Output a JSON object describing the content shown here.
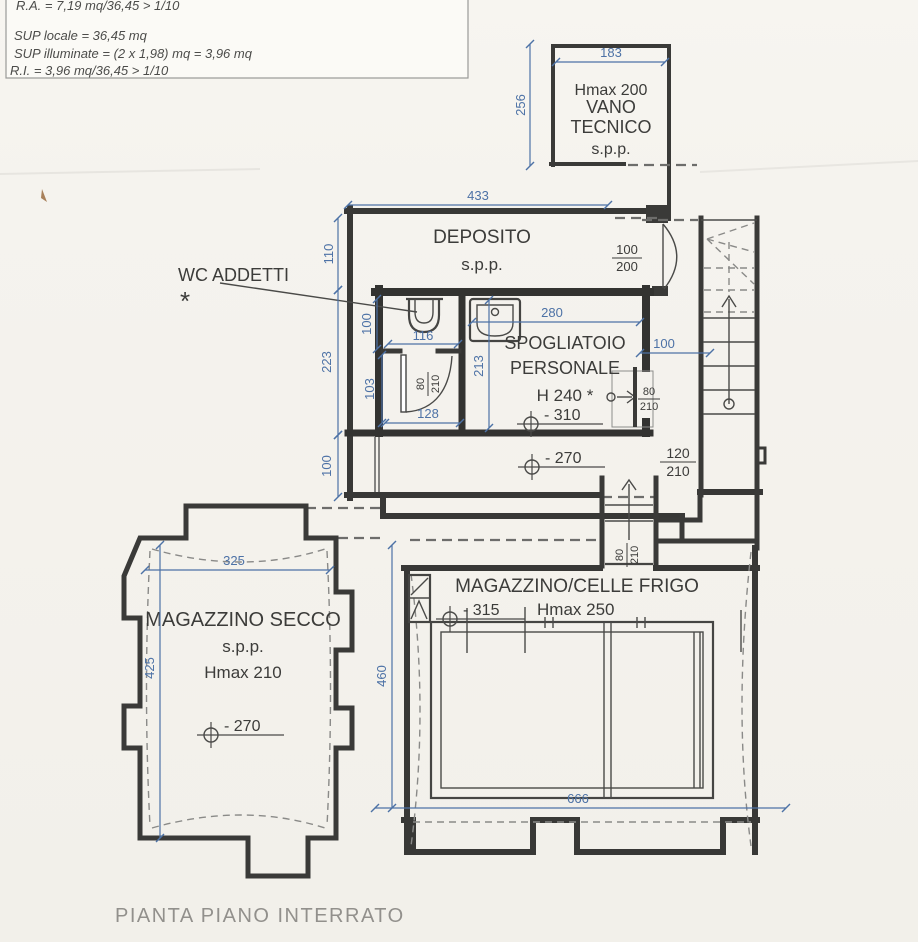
{
  "title": "PIANTA PIANO INTERRATO",
  "notes": {
    "line1": "R.A. = 7,19 mq/36,45 > 1/10",
    "line2": "SUP locale = 36,45 mq",
    "line3": "SUP illuminate = (2 x 1,98) mq = 3,96 mq",
    "line4": "R.I. = 3,96 mq/36,45 > 1/10"
  },
  "rooms": {
    "vano_tecnico": {
      "hmax": "Hmax 200",
      "name1": "VANO",
      "name2": "TECNICO",
      "spp": "s.p.p."
    },
    "deposito": {
      "name": "DEPOSITO",
      "spp": "s.p.p."
    },
    "wc_addetti": {
      "name": "WC ADDETTI",
      "note_mark": "*"
    },
    "spogliatoio": {
      "name1": "SPOGLIATOIO",
      "name2": "PERSONALE",
      "height": "H 240 *",
      "level": "- 310"
    },
    "corridoio": {
      "level": "- 270"
    },
    "magazzino_secco": {
      "name": "MAGAZZINO SECCO",
      "spp": "s.p.p.",
      "hmax": "Hmax 210",
      "level": "- 270"
    },
    "magazzino_frigo": {
      "name": "MAGAZZINO/CELLE FRIGO",
      "hmax": "Hmax 250",
      "level": "- 315"
    }
  },
  "dimensions": {
    "vano_width": "183",
    "vano_height": "256",
    "deposito_width": "433",
    "left_upper": "110",
    "left_mid": "223",
    "left_lower": "100",
    "wc_inner_height": "100",
    "wc_lobby_height": "103",
    "wc_width": "116",
    "lobby_width": "128",
    "spogliatoio_width": "280",
    "spogliatoio_height": "213",
    "corridor_right": "100",
    "secco_width": "325",
    "secco_height": "425",
    "frigo_height": "460",
    "frigo_width": "666"
  },
  "doors": {
    "deposito": {
      "w": "100",
      "h": "200"
    },
    "wc": {
      "w": "80",
      "h": "210"
    },
    "spogliatoio": {
      "w": "80",
      "h": "210"
    },
    "stairs": {
      "w": "120",
      "h": "210"
    },
    "frigo": {
      "w": "80",
      "h": "210"
    }
  },
  "colors": {
    "dimension": "#4d72a6",
    "wall": "#3a3a38",
    "title": "#92908c"
  }
}
